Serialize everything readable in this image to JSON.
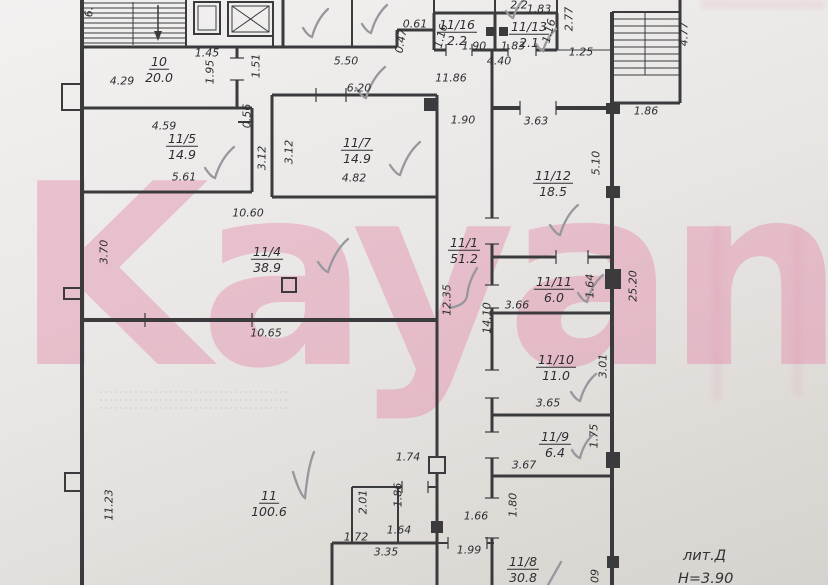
{
  "watermark": {
    "text": "Kayan",
    "color": "#e487a8"
  },
  "plan": {
    "liter": "лит.Д",
    "height_note": "Н=3.90",
    "rooms": [
      {
        "number": "10",
        "area": "20.0",
        "x": 159,
        "y": 68
      },
      {
        "number": "11/5",
        "area": "14.9",
        "x": 182,
        "y": 145
      },
      {
        "number": "11/7",
        "area": "14.9",
        "x": 357,
        "y": 149
      },
      {
        "number": "11/16",
        "area": "2.2",
        "x": 457,
        "y": 31
      },
      {
        "number": "11/13",
        "area": "2.1",
        "x": 529,
        "y": 33
      },
      {
        "number": "11/4",
        "area": "38.9",
        "x": 267,
        "y": 258
      },
      {
        "number": "11/1",
        "area": "51.2",
        "x": 464,
        "y": 249
      },
      {
        "number": "11/12",
        "area": "18.5",
        "x": 553,
        "y": 182
      },
      {
        "number": "11/11",
        "area": "6.0",
        "x": 554,
        "y": 288
      },
      {
        "number": "11/10",
        "area": "11.0",
        "x": 556,
        "y": 366
      },
      {
        "number": "11/9",
        "area": "6.4",
        "x": 555,
        "y": 443
      },
      {
        "number": "11",
        "area": "100.6",
        "x": 269,
        "y": 502
      },
      {
        "number": "11/8",
        "area": "30.8",
        "x": 523,
        "y": 568
      }
    ],
    "dimensions": [
      {
        "t": "6.",
        "x": 89,
        "y": 12,
        "r": -90
      },
      {
        "t": "1.45",
        "x": 207,
        "y": 53
      },
      {
        "t": "1.95",
        "x": 210,
        "y": 72,
        "r": -90
      },
      {
        "t": "1.51",
        "x": 256,
        "y": 66,
        "r": -90
      },
      {
        "t": "0.56",
        "x": 247,
        "y": 116,
        "r": -90
      },
      {
        "t": "4.29",
        "x": 122,
        "y": 81
      },
      {
        "t": "5.50",
        "x": 346,
        "y": 61
      },
      {
        "t": "0.61",
        "x": 415,
        "y": 24
      },
      {
        "t": "0.47",
        "x": 401,
        "y": 41,
        "r": -80
      },
      {
        "t": "1.16",
        "x": 441,
        "y": 36,
        "r": -75
      },
      {
        "t": "1.90",
        "x": 474,
        "y": 46
      },
      {
        "t": "1.83",
        "x": 513,
        "y": 46
      },
      {
        "t": "1.16",
        "x": 549,
        "y": 31,
        "r": -75
      },
      {
        "t": "2.2",
        "x": 519,
        "y": 5
      },
      {
        "t": "1.83",
        "x": 539,
        "y": 9
      },
      {
        "t": "2.77",
        "x": 569,
        "y": 19,
        "r": -90
      },
      {
        "t": "1.25",
        "x": 581,
        "y": 52
      },
      {
        "t": "4.40",
        "x": 499,
        "y": 61
      },
      {
        "t": "11.86",
        "x": 451,
        "y": 78
      },
      {
        "t": "6.20",
        "x": 359,
        "y": 88
      },
      {
        "t": "1.90",
        "x": 463,
        "y": 120
      },
      {
        "t": "4.59",
        "x": 164,
        "y": 126
      },
      {
        "t": "5.61",
        "x": 184,
        "y": 177
      },
      {
        "t": "3.12",
        "x": 262,
        "y": 158,
        "r": -90
      },
      {
        "t": "3.12",
        "x": 289,
        "y": 152,
        "r": -90
      },
      {
        "t": "4.82",
        "x": 354,
        "y": 178
      },
      {
        "t": "3.63",
        "x": 536,
        "y": 121
      },
      {
        "t": "5.10",
        "x": 596,
        "y": 163,
        "r": -90
      },
      {
        "t": "4.77",
        "x": 684,
        "y": 34,
        "r": -90
      },
      {
        "t": "1.86",
        "x": 646,
        "y": 111
      },
      {
        "t": "10.60",
        "x": 248,
        "y": 213
      },
      {
        "t": "3.70",
        "x": 104,
        "y": 252,
        "r": -90
      },
      {
        "t": "12.35",
        "x": 447,
        "y": 300,
        "r": -90
      },
      {
        "t": "14.10",
        "x": 487,
        "y": 318,
        "r": -90
      },
      {
        "t": "3.66",
        "x": 517,
        "y": 305
      },
      {
        "t": "1.64",
        "x": 590,
        "y": 286,
        "r": -90
      },
      {
        "t": "25.20",
        "x": 633,
        "y": 286,
        "r": -90
      },
      {
        "t": "10.65",
        "x": 266,
        "y": 333
      },
      {
        "t": "3.01",
        "x": 603,
        "y": 366,
        "r": -90
      },
      {
        "t": "3.65",
        "x": 548,
        "y": 403
      },
      {
        "t": "1.75",
        "x": 594,
        "y": 436,
        "r": -90
      },
      {
        "t": "3.67",
        "x": 524,
        "y": 465
      },
      {
        "t": "11.23",
        "x": 109,
        "y": 505,
        "r": -90
      },
      {
        "t": "1.74",
        "x": 408,
        "y": 457
      },
      {
        "t": "2.01",
        "x": 363,
        "y": 502,
        "r": -90
      },
      {
        "t": "1.86",
        "x": 398,
        "y": 495,
        "r": -90
      },
      {
        "t": "1.72",
        "x": 356,
        "y": 537
      },
      {
        "t": "1.64",
        "x": 399,
        "y": 530
      },
      {
        "t": "3.35",
        "x": 386,
        "y": 552
      },
      {
        "t": "1.66",
        "x": 476,
        "y": 516
      },
      {
        "t": "1.99",
        "x": 469,
        "y": 550
      },
      {
        "t": "1.80",
        "x": 513,
        "y": 505,
        "r": -90
      },
      {
        "t": "09",
        "x": 595,
        "y": 576,
        "r": -90
      }
    ]
  },
  "colors": {
    "paper": "#eae8e6",
    "line": "#3b3b3e",
    "checkmark": "#97979d",
    "watermark_pink": "#e487a8"
  }
}
